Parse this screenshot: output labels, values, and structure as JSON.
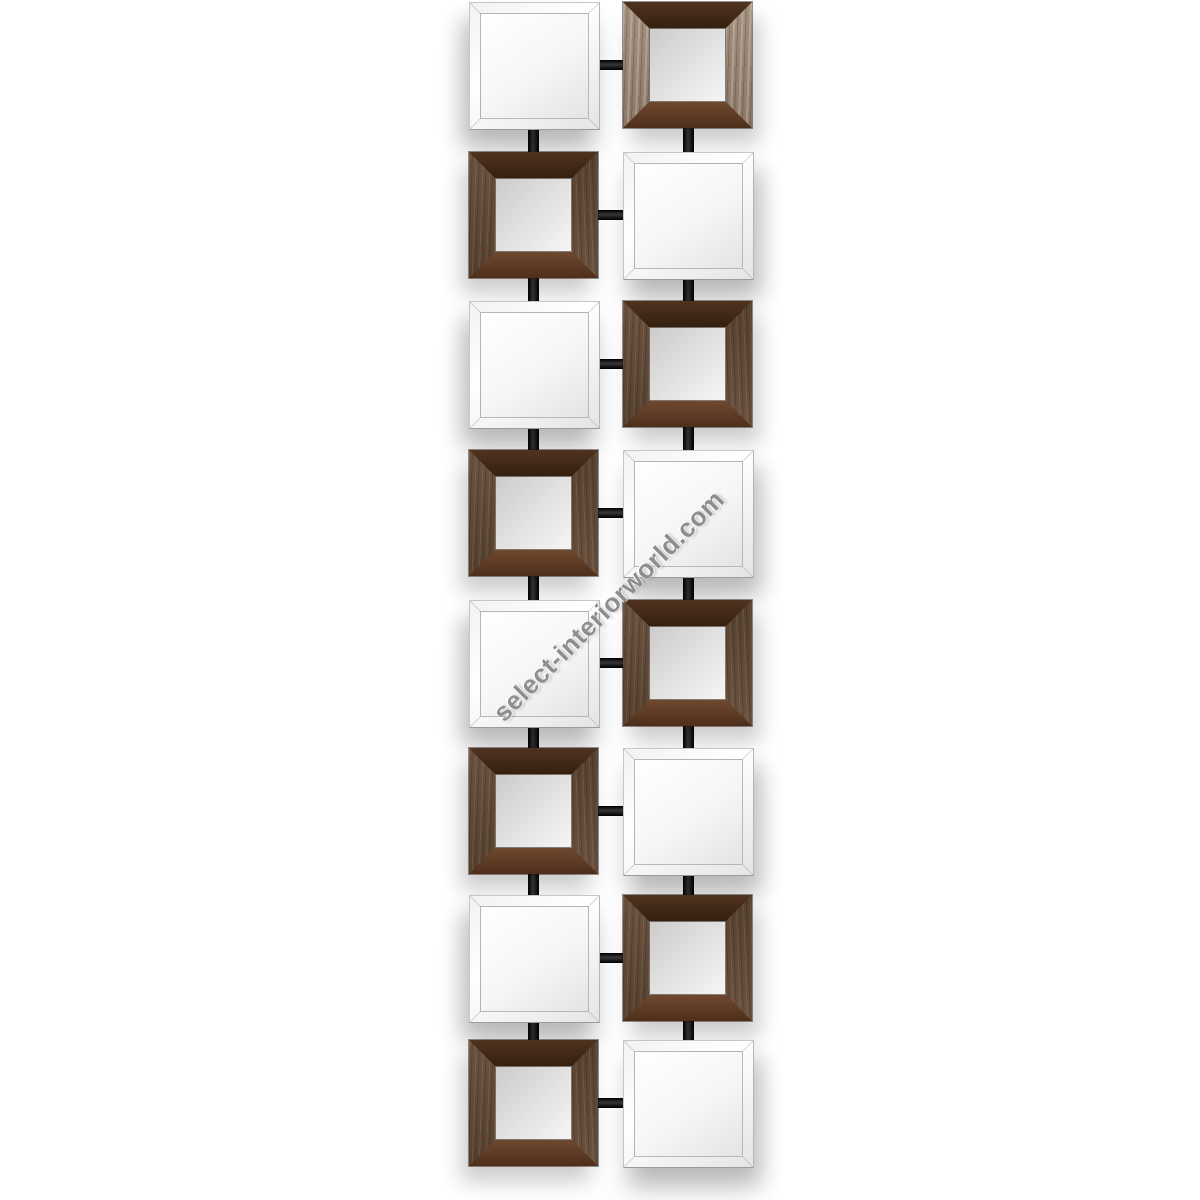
{
  "watermark": {
    "text": "select-interiorworld.com",
    "color": "#8e8e8e",
    "rotation_deg": -45
  },
  "artwork": {
    "kind": "wall-mirror-product-photo",
    "rows": 8,
    "columns": 2,
    "tile": {
      "width": 129,
      "height": 126
    },
    "row_tops": [
      2,
      152,
      301,
      450,
      600,
      748,
      895,
      1040
    ],
    "column_lefts": [
      469,
      623
    ],
    "column_centers": [
      533,
      688
    ],
    "pattern": [
      [
        "plain",
        "wood-light"
      ],
      [
        "wood",
        "plain"
      ],
      [
        "plain",
        "wood"
      ],
      [
        "wood",
        "plain"
      ],
      [
        "plain",
        "wood"
      ],
      [
        "wood",
        "plain"
      ],
      [
        "plain",
        "wood"
      ],
      [
        "wood",
        "plain"
      ]
    ],
    "colors": {
      "background": "#ffffff",
      "plain_mirror_light": "#f2f2f2",
      "plain_mirror_dark": "#e4e4e4",
      "wood_dark": "#35200f",
      "wood_side1": "#6b523f",
      "wood_side2": "#55402e",
      "wood_reddish": "#6f482f",
      "framed_mirror_light": "#f6f6f6",
      "framed_mirror_dark": "#cbcbcb",
      "connector_black": "#0f0f0f",
      "shadow": "rgba(0,0,0,0.20)"
    }
  }
}
